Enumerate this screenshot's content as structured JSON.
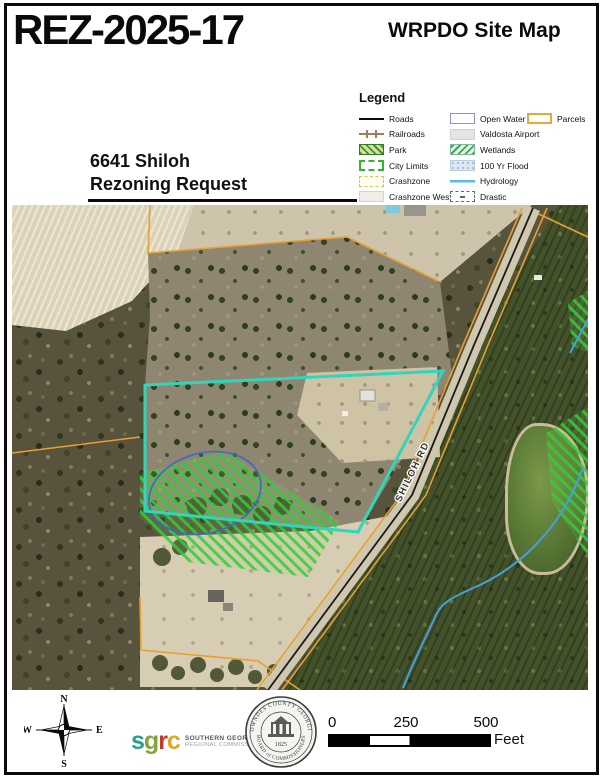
{
  "page": {
    "case_number": "REZ-2025-17",
    "map_title": "WRPDO Site Map",
    "subtitle_line1": "6641 Shiloh",
    "subtitle_line2": "Rezoning Request"
  },
  "legend": {
    "title": "Legend",
    "col1": [
      {
        "label": "Roads",
        "swatch": "road-line"
      },
      {
        "label": "Railroads",
        "swatch": "railroad-line"
      },
      {
        "label": "Park",
        "swatch": "green-hatch-box"
      },
      {
        "label": "City Limits",
        "swatch": "green-dashed-box"
      },
      {
        "label": "Crashzone",
        "swatch": "yellow-dashed-box"
      },
      {
        "label": "Crashzone West",
        "swatch": "gray-box"
      },
      {
        "label": "Urban Service Area",
        "swatch": "navy-outline-box"
      }
    ],
    "col2": [
      {
        "label": "Open Water",
        "swatch": "blue-outline-box"
      },
      {
        "label": "Valdosta Airport",
        "swatch": "light-gray-box"
      },
      {
        "label": "Wetlands",
        "swatch": "green-hatch-box"
      },
      {
        "label": "100 Yr Flood",
        "swatch": "blue-stipple-box"
      },
      {
        "label": "Hydrology",
        "swatch": "blue-line"
      },
      {
        "label": "Drastic",
        "swatch": "dashed-outline-box"
      },
      {
        "label": "Recharge Areas",
        "swatch": "cream-box"
      }
    ],
    "col3": [
      {
        "label": "Parcels",
        "swatch": "orange-outline-box"
      }
    ]
  },
  "map": {
    "road_label": "SHILOH RD"
  },
  "compass": {
    "n": "N",
    "e": "E",
    "s": "S",
    "w": "W"
  },
  "logos": {
    "sgrc": {
      "letters": [
        "s",
        "g",
        "r",
        "c"
      ],
      "line1": "SOUTHERN GEORGIA",
      "line2": "REGIONAL COMMISSION"
    },
    "seal": {
      "top": "LOWNDES COUNTY GEORGIA",
      "bottom": "BOARD of COMMISSIONERS",
      "year": "1825"
    }
  },
  "scale_bar": {
    "labels": [
      "0",
      "250",
      "500"
    ],
    "unit": "Feet"
  },
  "colors": {
    "parcel_orange": "#e8a030",
    "subject_parcel_cyan": "#2fd6bb",
    "hydrology_blue": "#45a0dc",
    "wetland_hatch_green": "#35cc35",
    "drastic_ellipse_blue": "#3f66c8",
    "urban_service_navy": "#1b1b8f",
    "city_limits_green": "#2db82d",
    "sgrc_s": "#2a9d8f",
    "sgrc_g": "#7fa53c",
    "sgrc_r": "#c0392b",
    "sgrc_c": "#e4a425"
  }
}
